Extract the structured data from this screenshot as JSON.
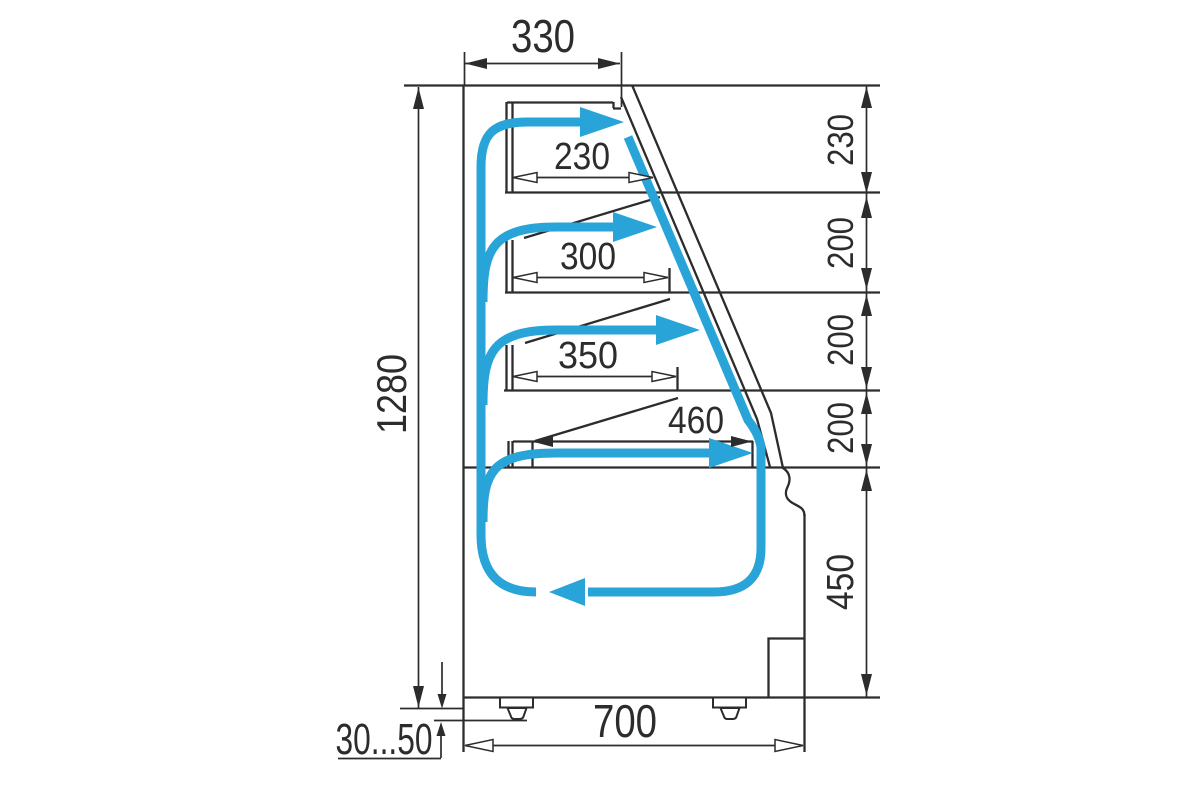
{
  "diagram": {
    "description": "Refrigerated display case side cross-section with cold air flow circuit",
    "colors": {
      "line": "#2c2c2c",
      "airflow": "#29a4d9",
      "background": "#ffffff"
    },
    "dims": {
      "top_width": "330",
      "overall_height": "1280",
      "base_depth": "700",
      "legs_range": "30...50",
      "shelf_depths": [
        "230",
        "300",
        "350",
        "460"
      ],
      "section_heights": [
        "230",
        "200",
        "200",
        "200",
        "450"
      ]
    }
  }
}
